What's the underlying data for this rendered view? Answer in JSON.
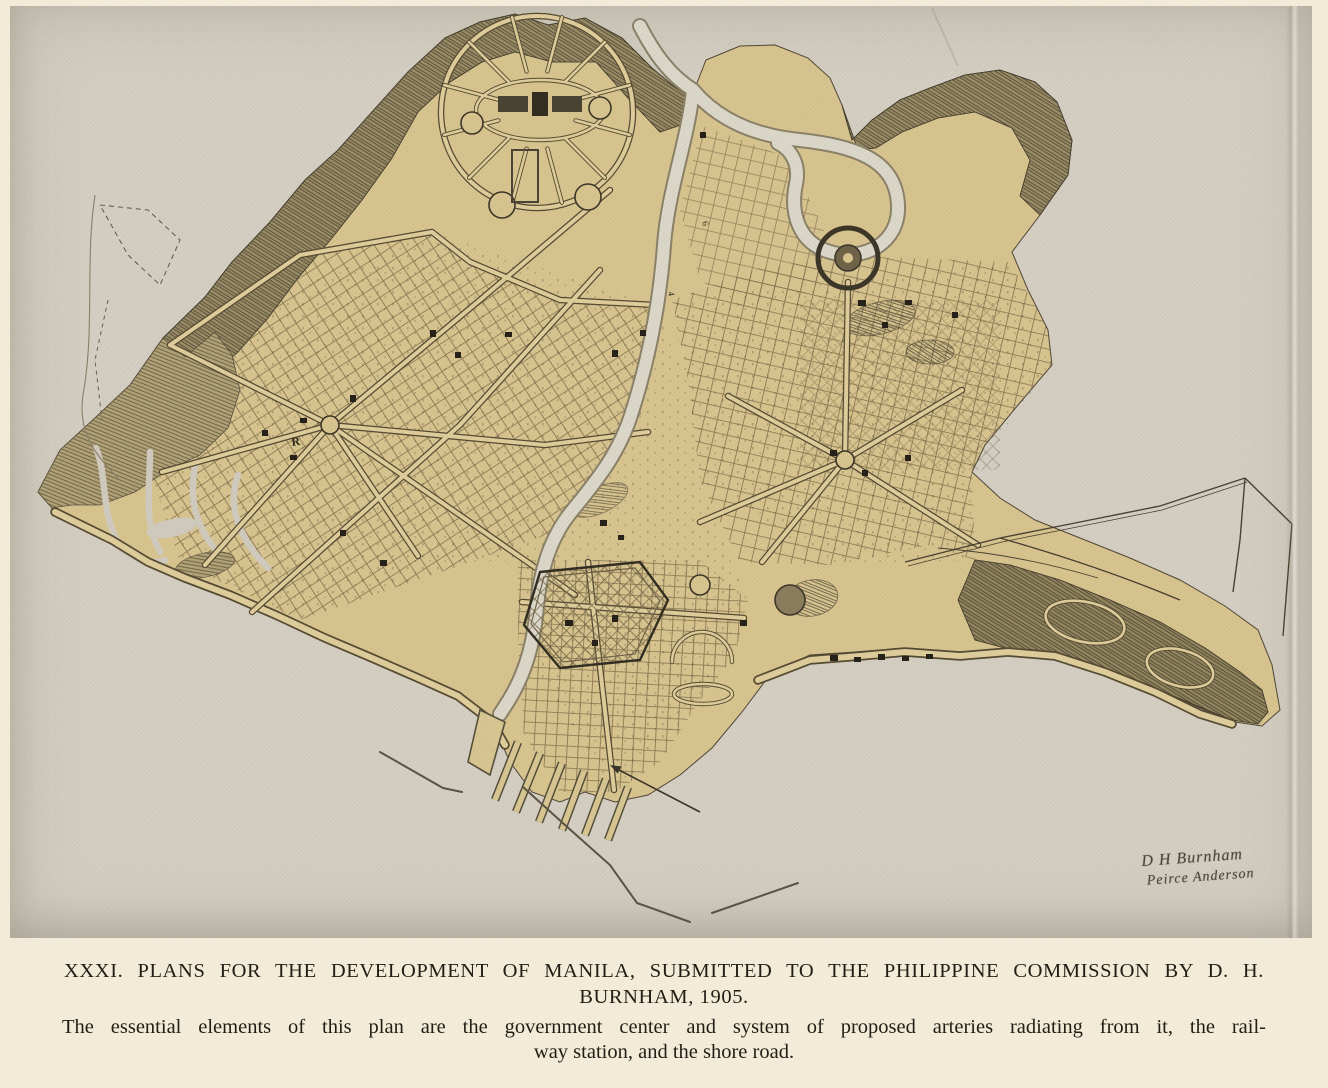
{
  "caption": {
    "title_line1": "XXXI. PLANS FOR THE DEVELOPMENT OF MANILA, SUBMITTED TO THE PHILIPPINE COMMISSION BY D. H.",
    "title_line2": "BURNHAM, 1905.",
    "body_line1": "The essential elements of this plan are the government center and system of proposed arteries radiating from it, the rail-",
    "body_line2": "way station, and the shore road."
  },
  "map": {
    "signature_line1": "D H Burnham",
    "signature_line2": "Peirce Anderson",
    "labels": [
      {
        "text": "R"
      },
      {
        "text": "4"
      },
      {
        "text": "6"
      }
    ]
  },
  "colors": {
    "page_paper": "#f1ebd7",
    "plate_paper": "#d4cfc2",
    "land_tan": "#d8c48f",
    "dark_wooded": "#9b8d66",
    "water": "#dcd8c9",
    "ink": "#3a342a",
    "road_fill": "#dfcd9b",
    "road_edge": "#5a4e35"
  }
}
